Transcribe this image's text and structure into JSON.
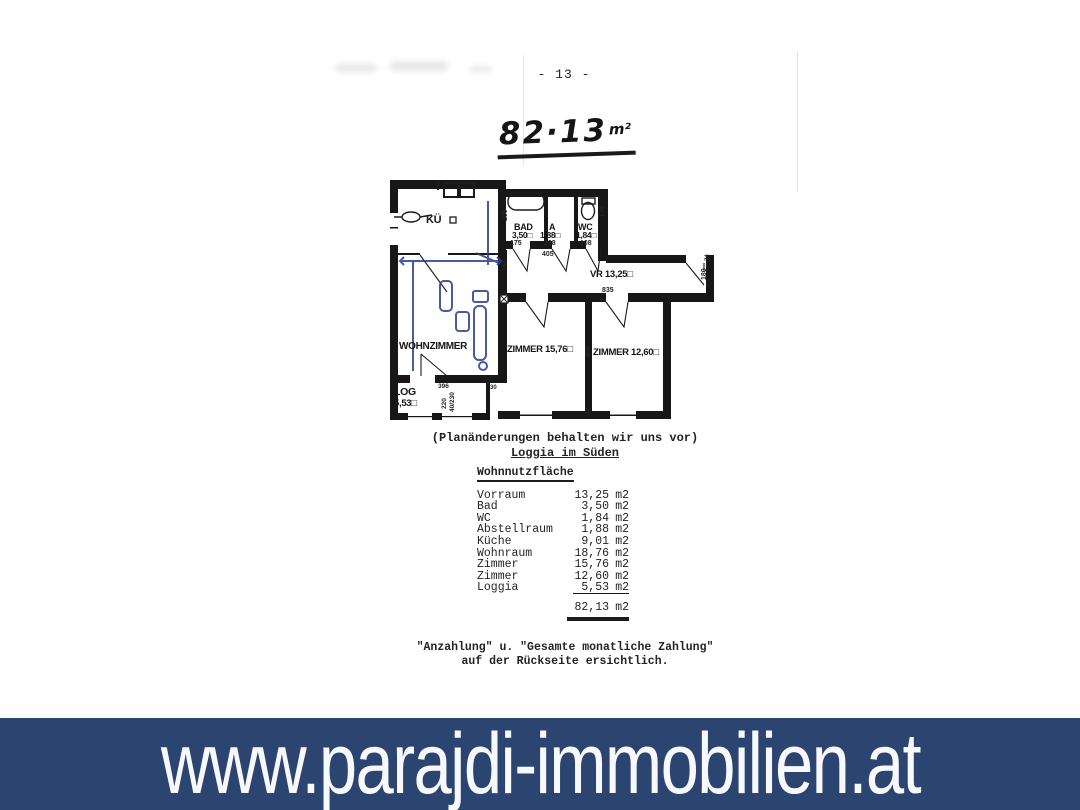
{
  "page": {
    "page_number": "- 13 -",
    "handwritten": {
      "value": "82·13",
      "unit": "m²"
    }
  },
  "plan": {
    "rooms": {
      "kueche": "KÜ",
      "bad": "BAD",
      "bad_area": "3,50□",
      "abstell": "A",
      "abstell_area": "1,88□",
      "wc": "WC",
      "wc_area": "1,84□",
      "vorraum": "VR 13,25□",
      "wohnzimmer": "WOHNZIMMER",
      "zimmer1": "ZIMMER 15,76□",
      "zimmer2": "ZIMMER 12,60□",
      "loggia": "LOG",
      "loggia_area": "5,53□"
    },
    "dims": {
      "d175": "175",
      "d108a": "108",
      "d108b": "108",
      "d405": "405",
      "d200": "200",
      "d170": "170",
      "d168": "168",
      "d835": "835",
      "d74": "74",
      "d180": "180",
      "d450": "450",
      "d30a": "30",
      "d30b": "30",
      "d396": "396",
      "d220": "220",
      "d40230": "40/230"
    }
  },
  "notes": {
    "plan_change": "(Planänderungen behalten wir uns vor)",
    "loggia_south": "Loggia im Süden"
  },
  "table": {
    "title": "Wohnnutzfläche",
    "rows": [
      {
        "label": "Vorraum",
        "value": "13,25",
        "unit": "m2"
      },
      {
        "label": "Bad",
        "value": "3,50",
        "unit": "m2"
      },
      {
        "label": "WC",
        "value": "1,84",
        "unit": "m2"
      },
      {
        "label": "Abstellraum",
        "value": "1,88",
        "unit": "m2"
      },
      {
        "label": "Küche",
        "value": "9,01",
        "unit": "m2"
      },
      {
        "label": "Wohnraum",
        "value": "18,76",
        "unit": "m2"
      },
      {
        "label": "Zimmer",
        "value": "15,76",
        "unit": "m2"
      },
      {
        "label": "Zimmer",
        "value": "12,60",
        "unit": "m2"
      },
      {
        "label": "Loggia",
        "value": "5,53",
        "unit": "m2"
      }
    ],
    "total": {
      "value": "82,13",
      "unit": "m2"
    }
  },
  "footer": {
    "line1": "\"Anzahlung\" u. \"Gesamte monatliche Zahlung\"",
    "line2": "auf der Rückseite ersichtlich."
  },
  "banner": {
    "url": "www.parajdi-immobilien.at"
  },
  "colors": {
    "banner_bg": "#2b4470",
    "ink": "#1c1c1c",
    "pen_blue": "#2a3e8c"
  }
}
